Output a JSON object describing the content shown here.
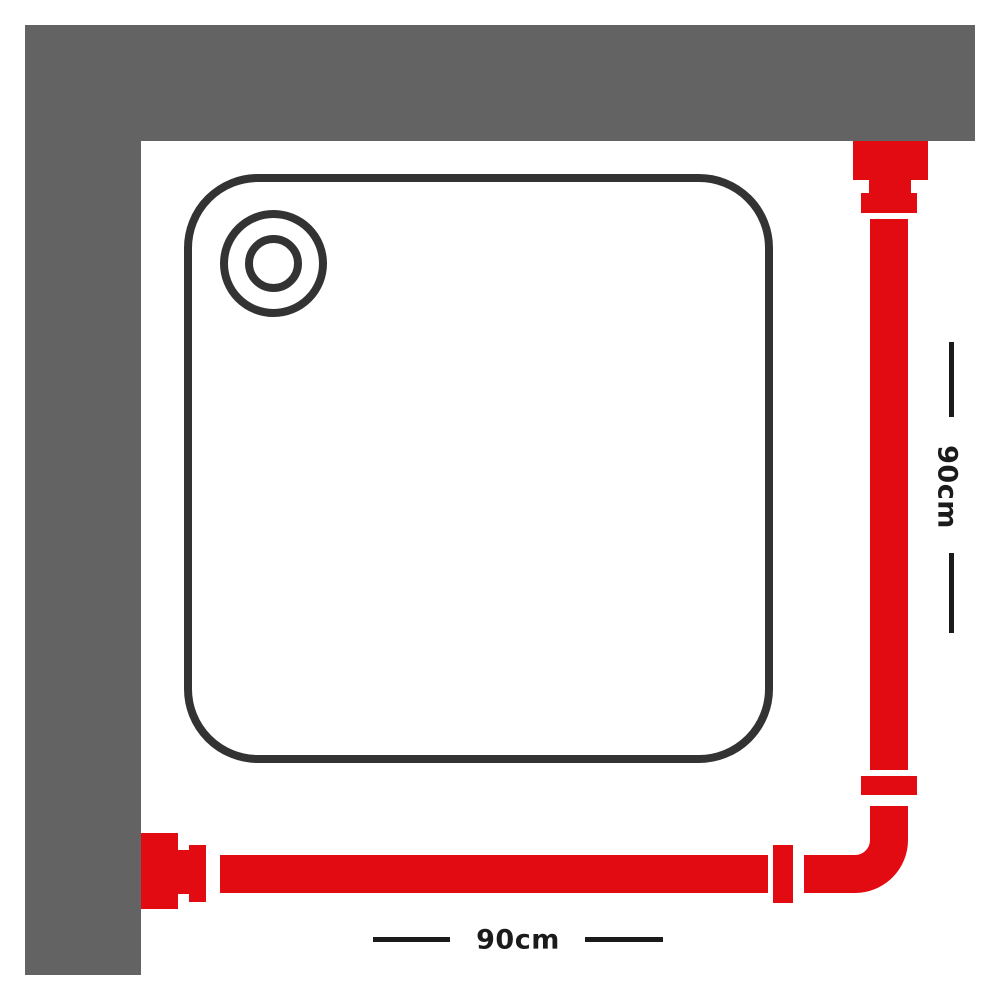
{
  "colors": {
    "wall_grey": "#636363",
    "rail_red": "#e20b12",
    "tray_outline": "#333333",
    "dimension_black": "#1b1b1b",
    "background_white": "#ffffff"
  },
  "diagram": {
    "dimensions": {
      "right": {
        "label": "90cm"
      },
      "bottom": {
        "label": "90cm"
      }
    }
  }
}
